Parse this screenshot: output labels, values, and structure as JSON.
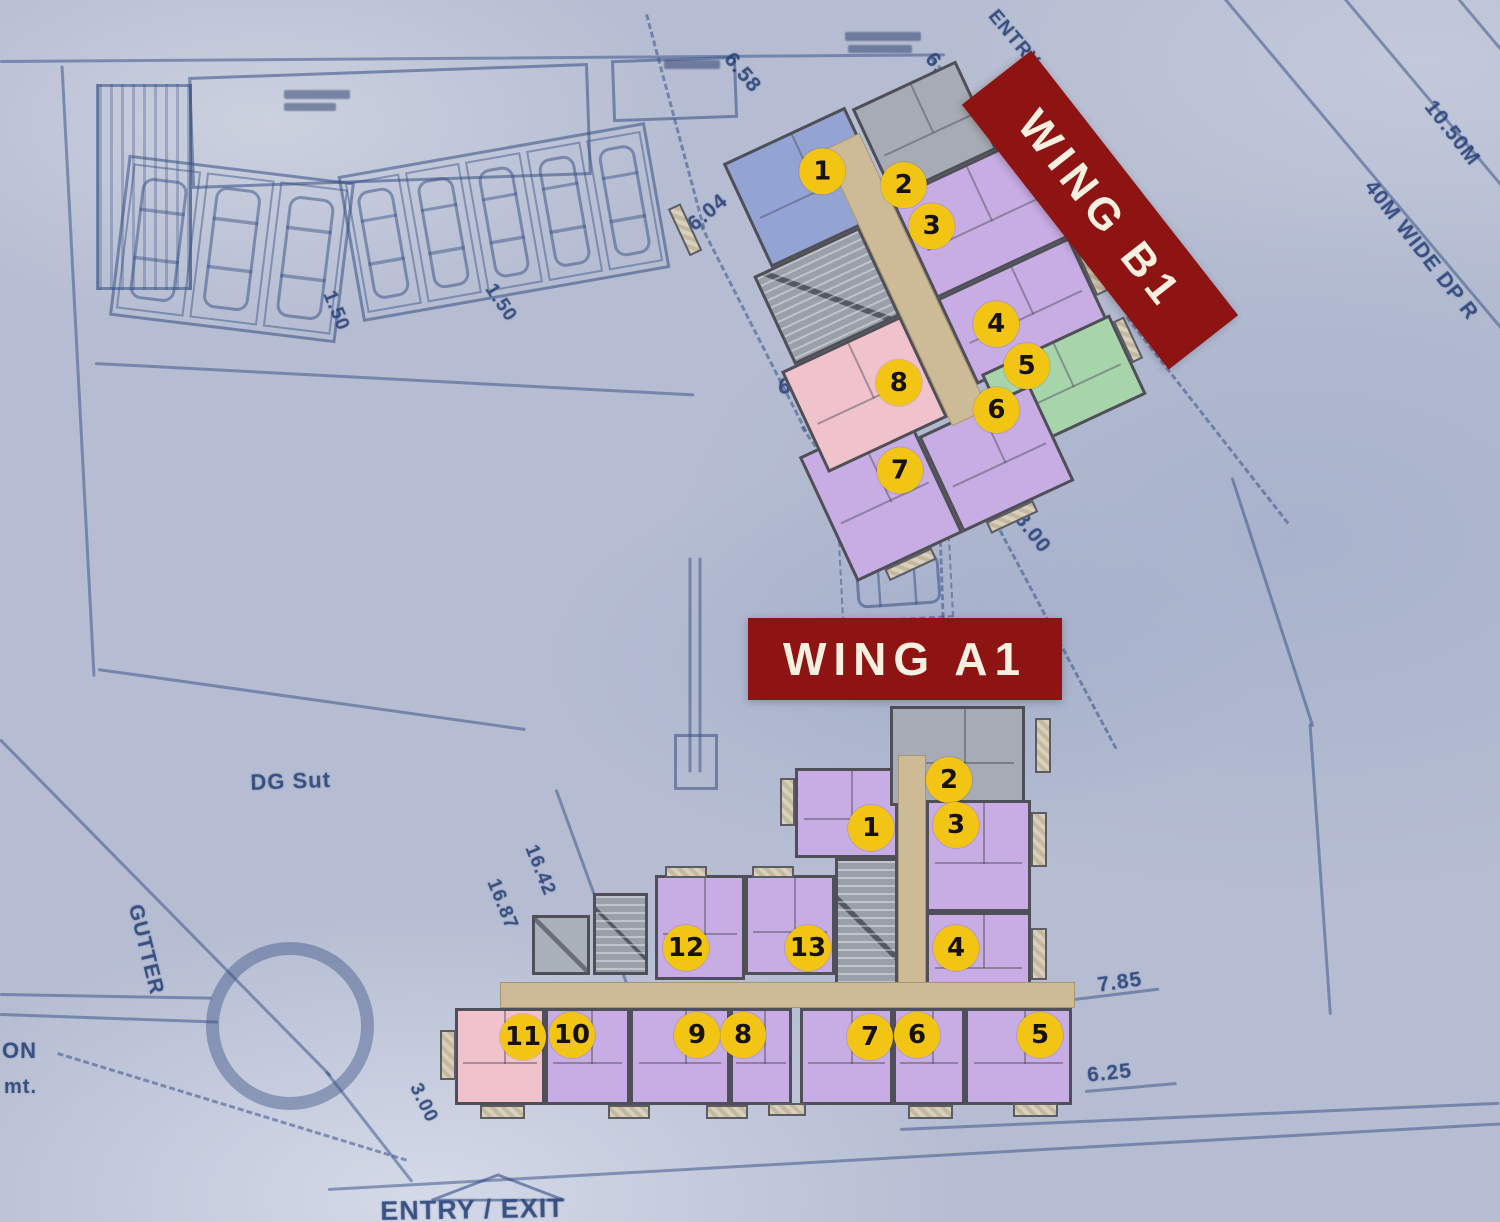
{
  "colors": {
    "background": "#b6bdd2",
    "blueprint_ink": "#32508c",
    "wing_label_bg": "#8e1414",
    "wing_label_text": "#f7efdf",
    "marker_bg": "#f2c413",
    "marker_text": "#17120a",
    "wall": "#4f4f57",
    "corridor": "#cdbb97",
    "unit_purple": "#c7ade3",
    "unit_blue": "#93a3d4",
    "unit_gray": "#a7abb5",
    "unit_pink": "#f0c2cb",
    "unit_green": "#a8d4ab"
  },
  "wings": {
    "b1": {
      "label": "WING B1",
      "label_box": {
        "x": 932,
        "y": 166,
        "w": 336,
        "h": 88,
        "rot": 52
      },
      "plan_box": {
        "x": 750,
        "y": 90,
        "w": 360,
        "h": 445,
        "rot": -25,
        "marker_counter_rot": 25
      },
      "corridors": [
        {
          "x": 152,
          "y": 30,
          "w": 40,
          "h": 305
        }
      ],
      "cores": [
        {
          "x": 35,
          "y": 115,
          "w": 117,
          "h": 98
        }
      ],
      "lifts": [],
      "units": [
        {
          "num": "1",
          "color": "blue",
          "x": 55,
          "y": 0,
          "w": 135,
          "h": 115
        },
        {
          "num": "2",
          "color": "gray",
          "x": 195,
          "y": 5,
          "w": 115,
          "h": 98
        },
        {
          "num": "3",
          "color": "purple",
          "x": 192,
          "y": 103,
          "w": 150,
          "h": 110
        },
        {
          "num": "4",
          "color": "purple",
          "x": 192,
          "y": 213,
          "w": 146,
          "h": 95
        },
        {
          "num": "5",
          "color": "green",
          "x": 200,
          "y": 300,
          "w": 142,
          "h": 88
        },
        {
          "num": "6",
          "color": "purple",
          "x": 117,
          "y": 330,
          "w": 123,
          "h": 106
        },
        {
          "num": "7",
          "color": "purple",
          "x": 0,
          "y": 298,
          "w": 117,
          "h": 138
        },
        {
          "num": "8",
          "color": "pink",
          "x": 20,
          "y": 213,
          "w": 132,
          "h": 112
        }
      ],
      "balconies": [
        {
          "x": -14,
          "y": 18,
          "w": 14,
          "h": 52
        },
        {
          "x": 342,
          "y": 115,
          "w": 13,
          "h": 52
        },
        {
          "x": 338,
          "y": 228,
          "w": 13,
          "h": 50
        },
        {
          "x": 342,
          "y": 308,
          "w": 12,
          "h": 46
        },
        {
          "x": 30,
          "y": 436,
          "w": 52,
          "h": 13
        },
        {
          "x": 142,
          "y": 436,
          "w": 52,
          "h": 13
        }
      ],
      "markers": [
        {
          "num": "1",
          "x": 142,
          "y": 49
        },
        {
          "num": "2",
          "x": 210,
          "y": 96
        },
        {
          "num": "3",
          "x": 218,
          "y": 145
        },
        {
          "num": "4",
          "x": 235,
          "y": 261
        },
        {
          "num": "5",
          "x": 245,
          "y": 312
        },
        {
          "num": "6",
          "x": 199,
          "y": 339
        },
        {
          "num": "7",
          "x": 86,
          "y": 353
        },
        {
          "num": "8",
          "x": 122,
          "y": 273
        }
      ]
    },
    "a1": {
      "label": "WING A1",
      "label_box": {
        "x": 748,
        "y": 618,
        "w": 314,
        "h": 82,
        "rot": 0
      },
      "plan_box": {
        "x": 440,
        "y": 700,
        "w": 650,
        "h": 430,
        "rot": 0,
        "marker_counter_rot": 0
      },
      "corridors": [
        {
          "x": 458,
          "y": 55,
          "w": 28,
          "h": 252
        },
        {
          "x": 60,
          "y": 282,
          "w": 575,
          "h": 26
        }
      ],
      "cores": [
        {
          "x": 395,
          "y": 158,
          "w": 63,
          "h": 140
        },
        {
          "x": 153,
          "y": 193,
          "w": 55,
          "h": 82
        }
      ],
      "lifts": [
        {
          "x": 92,
          "y": 215,
          "w": 58,
          "h": 60
        }
      ],
      "units": [
        {
          "num": "1",
          "color": "purple",
          "x": 355,
          "y": 68,
          "w": 103,
          "h": 90
        },
        {
          "num": "2",
          "color": "gray",
          "x": 450,
          "y": 6,
          "w": 135,
          "h": 100
        },
        {
          "num": "3",
          "color": "purple",
          "x": 486,
          "y": 100,
          "w": 105,
          "h": 112
        },
        {
          "num": "4",
          "color": "purple",
          "x": 486,
          "y": 212,
          "w": 105,
          "h": 98
        },
        {
          "num": "5",
          "color": "purple",
          "x": 525,
          "y": 308,
          "w": 107,
          "h": 97
        },
        {
          "num": "6",
          "color": "purple",
          "x": 453,
          "y": 308,
          "w": 72,
          "h": 97
        },
        {
          "num": "7",
          "color": "purple",
          "x": 360,
          "y": 308,
          "w": 93,
          "h": 97
        },
        {
          "num": "8",
          "color": "purple",
          "x": 290,
          "y": 308,
          "w": 62,
          "h": 97
        },
        {
          "num": "9",
          "color": "purple",
          "x": 190,
          "y": 308,
          "w": 100,
          "h": 97
        },
        {
          "num": "10",
          "color": "purple",
          "x": 105,
          "y": 308,
          "w": 85,
          "h": 97
        },
        {
          "num": "11",
          "color": "pink",
          "x": 15,
          "y": 308,
          "w": 90,
          "h": 97
        },
        {
          "num": "12",
          "color": "purple",
          "x": 215,
          "y": 175,
          "w": 90,
          "h": 105
        },
        {
          "num": "13",
          "color": "purple",
          "x": 305,
          "y": 175,
          "w": 90,
          "h": 100
        }
      ],
      "balconies": [
        {
          "x": 340,
          "y": 78,
          "w": 15,
          "h": 48
        },
        {
          "x": 595,
          "y": 18,
          "w": 16,
          "h": 55
        },
        {
          "x": 591,
          "y": 112,
          "w": 16,
          "h": 55
        },
        {
          "x": 591,
          "y": 228,
          "w": 16,
          "h": 52
        },
        {
          "x": 225,
          "y": 166,
          "w": 42,
          "h": 12
        },
        {
          "x": 312,
          "y": 166,
          "w": 42,
          "h": 12
        },
        {
          "x": 40,
          "y": 405,
          "w": 45,
          "h": 14
        },
        {
          "x": 168,
          "y": 405,
          "w": 42,
          "h": 14
        },
        {
          "x": 266,
          "y": 405,
          "w": 42,
          "h": 14
        },
        {
          "x": 328,
          "y": 403,
          "w": 38,
          "h": 13
        },
        {
          "x": 468,
          "y": 405,
          "w": 45,
          "h": 14
        },
        {
          "x": 573,
          "y": 403,
          "w": 45,
          "h": 14
        },
        {
          "x": 0,
          "y": 330,
          "w": 16,
          "h": 50
        }
      ],
      "markers": [
        {
          "num": "1",
          "x": 431,
          "y": 128
        },
        {
          "num": "2",
          "x": 509,
          "y": 80
        },
        {
          "num": "3",
          "x": 516,
          "y": 125
        },
        {
          "num": "4",
          "x": 516,
          "y": 248
        },
        {
          "num": "5",
          "x": 600,
          "y": 335
        },
        {
          "num": "6",
          "x": 477,
          "y": 335
        },
        {
          "num": "7",
          "x": 430,
          "y": 337
        },
        {
          "num": "8",
          "x": 303,
          "y": 335
        },
        {
          "num": "9",
          "x": 257,
          "y": 335
        },
        {
          "num": "10",
          "x": 132,
          "y": 335
        },
        {
          "num": "11",
          "x": 83,
          "y": 337
        },
        {
          "num": "12",
          "x": 246,
          "y": 248
        },
        {
          "num": "13",
          "x": 368,
          "y": 248
        }
      ]
    }
  },
  "background": {
    "texts": [
      {
        "text": "6.58",
        "x": 737,
        "y": 48,
        "rot": 50,
        "size": 21
      },
      {
        "text": "6.03",
        "x": 938,
        "y": 48,
        "rot": 50,
        "size": 21
      },
      {
        "text": "ENTRY",
        "x": 1000,
        "y": 6,
        "rot": 50,
        "size": 19
      },
      {
        "text": "6.04",
        "x": 683,
        "y": 218,
        "rot": -40,
        "size": 21
      },
      {
        "text": "6.06",
        "x": 780,
        "y": 372,
        "rot": 7,
        "size": 23
      },
      {
        "text": "1.50",
        "x": 338,
        "y": 288,
        "rot": 68,
        "size": 19
      },
      {
        "text": "1.50",
        "x": 498,
        "y": 280,
        "rot": 56,
        "size": 19
      },
      {
        "text": "8.00",
        "x": 1028,
        "y": 508,
        "rot": 52,
        "size": 21
      },
      {
        "text": "10.50M",
        "x": 1438,
        "y": 96,
        "rot": 52,
        "size": 21
      },
      {
        "text": "40M WIDE DP R",
        "x": 1378,
        "y": 176,
        "rot": 52,
        "size": 21
      },
      {
        "text": "DG Sut",
        "x": 250,
        "y": 770,
        "rot": -2,
        "size": 22
      },
      {
        "text": "GUTTER",
        "x": 146,
        "y": 902,
        "rot": 76,
        "size": 21
      },
      {
        "text": "ON",
        "x": 2,
        "y": 1038,
        "rot": 0,
        "size": 22
      },
      {
        "text": "mt.",
        "x": 4,
        "y": 1076,
        "rot": 0,
        "size": 20
      },
      {
        "text": "16.42",
        "x": 540,
        "y": 842,
        "rot": 68,
        "size": 19
      },
      {
        "text": "16.87",
        "x": 502,
        "y": 876,
        "rot": 68,
        "size": 19
      },
      {
        "text": "3.00",
        "x": 424,
        "y": 1080,
        "rot": 64,
        "size": 19
      },
      {
        "text": "7.85",
        "x": 1096,
        "y": 974,
        "rot": -8,
        "size": 21
      },
      {
        "text": "6.25",
        "x": 1086,
        "y": 1064,
        "rot": -6,
        "size": 21
      },
      {
        "text": "ENTRY / EXIT",
        "x": 380,
        "y": 1196,
        "rot": -1,
        "size": 27
      }
    ],
    "lines": [
      {
        "x": 0,
        "y": 60,
        "len": 945,
        "rot": -0.4
      },
      {
        "x": 1212,
        "y": -18,
        "len": 580,
        "rot": 50
      },
      {
        "x": 1332,
        "y": -18,
        "len": 500,
        "rot": 50
      },
      {
        "x": 1448,
        "y": -15,
        "len": 380,
        "rot": 50
      },
      {
        "x": 62,
        "y": 64,
        "len": 612,
        "rot": 87
      },
      {
        "x": 98,
        "y": 668,
        "len": 432,
        "rot": 8
      },
      {
        "x": 95,
        "y": 362,
        "len": 600,
        "rot": 3
      },
      {
        "x": 0,
        "y": 738,
        "len": 472,
        "rot": 45.5
      },
      {
        "x": 326,
        "y": 1070,
        "len": 140,
        "rot": 52
      },
      {
        "x": 328,
        "y": 1188,
        "len": 1180,
        "rot": -3.2
      },
      {
        "x": 0,
        "y": 993,
        "len": 212,
        "rot": 1
      },
      {
        "x": 0,
        "y": 1013,
        "len": 218,
        "rot": 2
      },
      {
        "x": 1232,
        "y": 476,
        "len": 262,
        "rot": 72
      },
      {
        "x": 1310,
        "y": 722,
        "len": 292,
        "rot": 86
      },
      {
        "x": 690,
        "y": 556,
        "len": 215,
        "rot": 90
      },
      {
        "x": 700,
        "y": 556,
        "len": 215,
        "rot": 90
      },
      {
        "x": 1058,
        "y": 1000,
        "len": 102,
        "rot": -7
      },
      {
        "x": 1085,
        "y": 1090,
        "len": 92,
        "rot": -5
      },
      {
        "x": 556,
        "y": 788,
        "len": 252,
        "rot": 70
      },
      {
        "x": 900,
        "y": 1128,
        "len": 600,
        "rot": -2.5
      }
    ],
    "dashes": [
      {
        "x": 648,
        "y": 14,
        "len": 222,
        "rot": 75
      },
      {
        "x": 702,
        "y": 224,
        "len": 232,
        "rot": 63
      },
      {
        "x": 803,
        "y": 426,
        "len": 180,
        "rot": 55
      },
      {
        "x": 933,
        "y": 58,
        "len": 205,
        "rot": 47
      },
      {
        "x": 1128,
        "y": 316,
        "len": 262,
        "rot": 52
      },
      {
        "x": 941,
        "y": 514,
        "len": 104,
        "rot": 88
      },
      {
        "x": 993,
        "y": 514,
        "len": 265,
        "rot": 62
      },
      {
        "x": 58,
        "y": 1052,
        "len": 365,
        "rot": 17
      }
    ],
    "rects": [
      {
        "x": 190,
        "y": 70,
        "w": 400,
        "h": 112,
        "rot": -2,
        "style": "solid"
      },
      {
        "x": 96,
        "y": 84,
        "w": 96,
        "h": 206,
        "rot": 0,
        "style": "hatch"
      },
      {
        "x": 612,
        "y": 58,
        "w": 125,
        "h": 62,
        "rot": -2,
        "style": "solid"
      },
      {
        "x": 674,
        "y": 734,
        "w": 44,
        "h": 56,
        "rot": 0,
        "style": "solid"
      },
      {
        "x": 840,
        "y": 538,
        "w": 112,
        "h": 82,
        "rot": -3,
        "style": "dashedbox"
      }
    ],
    "carports": [
      {
        "x": 118,
        "y": 168,
        "w": 228,
        "h": 162,
        "rot": 7,
        "stalls": 3
      },
      {
        "x": 348,
        "y": 148,
        "w": 312,
        "h": 148,
        "rot": -10,
        "stalls": 5
      }
    ],
    "smudges": [
      {
        "x": 845,
        "y": 32,
        "w": 76,
        "h": 9
      },
      {
        "x": 848,
        "y": 45,
        "w": 64,
        "h": 8
      },
      {
        "x": 664,
        "y": 60,
        "w": 56,
        "h": 9
      },
      {
        "x": 284,
        "y": 90,
        "w": 66,
        "h": 9
      },
      {
        "x": 284,
        "y": 103,
        "w": 52,
        "h": 8
      },
      {
        "x": 870,
        "y": 516,
        "w": 56,
        "h": 10
      },
      {
        "x": 872,
        "y": 530,
        "w": 44,
        "h": 9
      }
    ],
    "ring": {
      "x": 206,
      "y": 942,
      "d": 168
    },
    "car": {
      "x": 856,
      "y": 556,
      "w": 84,
      "h": 50,
      "rot": -4
    },
    "entry_marker": {
      "x": 428,
      "y": 1172,
      "w": 140,
      "h": 32
    }
  }
}
